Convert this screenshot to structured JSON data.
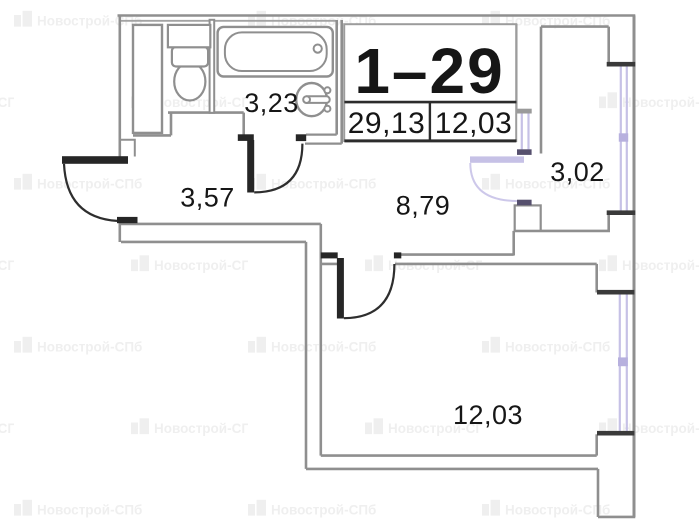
{
  "title_block": {
    "unit": "1–29",
    "area_total": "29,13",
    "area_secondary": "12,03"
  },
  "rooms": [
    {
      "name": "bathroom",
      "area": "3,23"
    },
    {
      "name": "hallway",
      "area": "3,57"
    },
    {
      "name": "kitchen",
      "area": "8,79"
    },
    {
      "name": "balcony",
      "area": "3,02"
    },
    {
      "name": "living-room",
      "area": "12,03"
    }
  ],
  "fixtures": [
    {
      "name": "toilet"
    },
    {
      "name": "bathtub"
    },
    {
      "name": "sink"
    },
    {
      "name": "duct-shaft"
    }
  ],
  "watermark": {
    "text": "Новострой-СПб"
  },
  "colors": {
    "wall": "#8f8f8f",
    "wall_dark": "#262626",
    "window": "#c6c1e6",
    "window_cap": "#56506e",
    "text": "#161616",
    "background": "#ffffff"
  }
}
